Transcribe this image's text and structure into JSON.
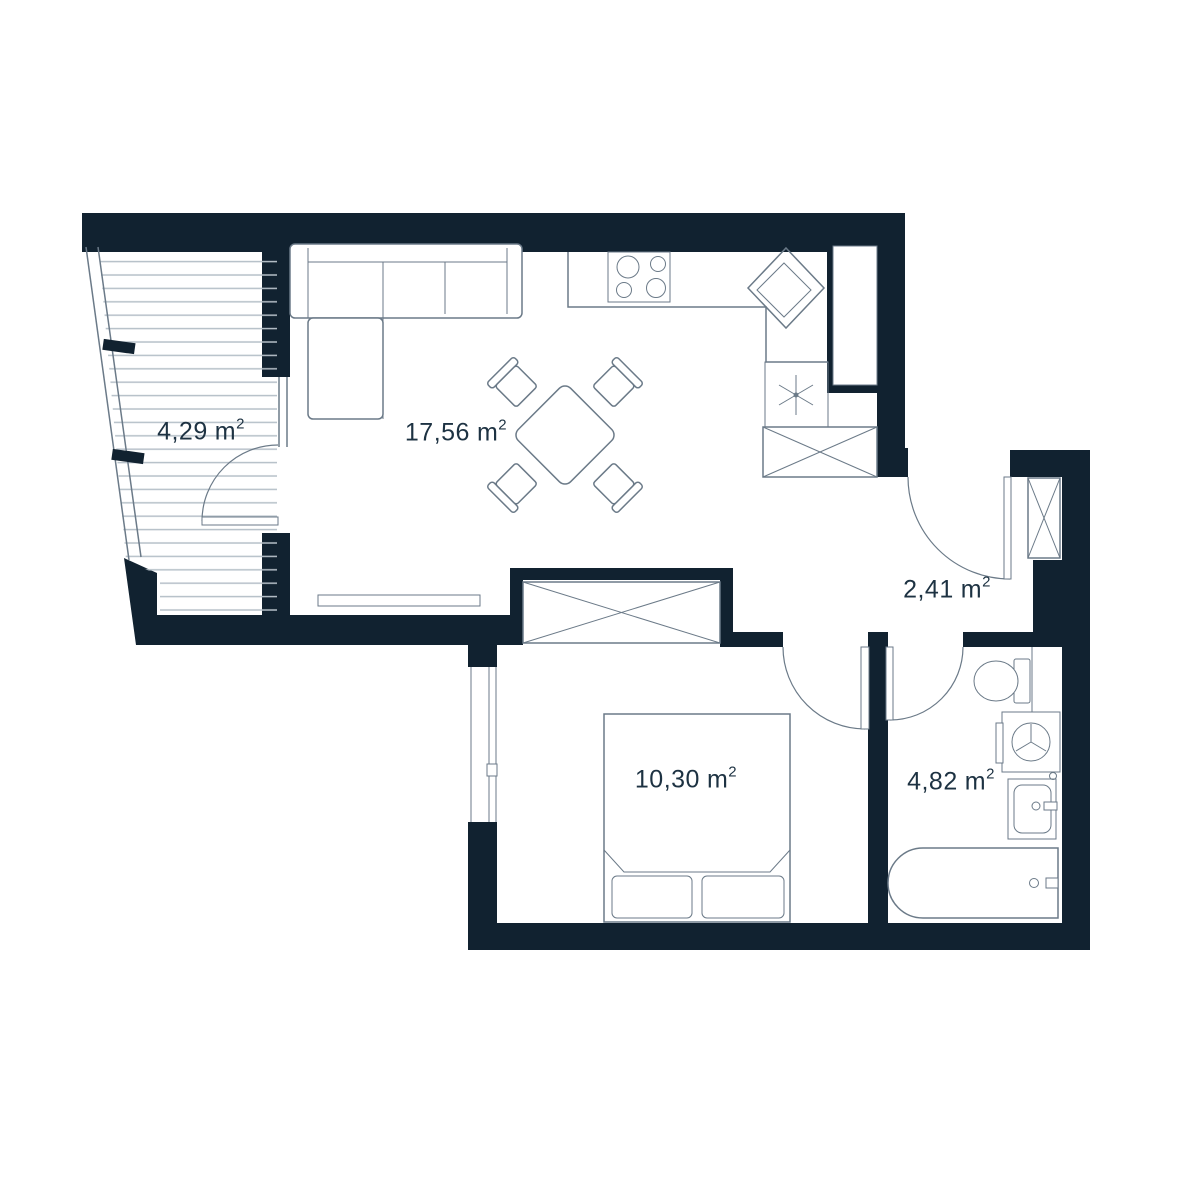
{
  "colors": {
    "wall": "#112230",
    "line": "#6b7a88",
    "line_light": "#b6c0c8",
    "text": "#1d3242",
    "bg": "#ffffff"
  },
  "rooms": [
    {
      "name": "balcony",
      "area": "4,29",
      "unit": "m",
      "exp": "2"
    },
    {
      "name": "living-room-kitchen",
      "area": "17,56",
      "unit": "m",
      "exp": "2"
    },
    {
      "name": "hallway",
      "area": "2,41",
      "unit": "m",
      "exp": "2"
    },
    {
      "name": "bedroom",
      "area": "10,30",
      "unit": "m",
      "exp": "2"
    },
    {
      "name": "bathroom",
      "area": "4,82",
      "unit": "m",
      "exp": "2"
    }
  ]
}
